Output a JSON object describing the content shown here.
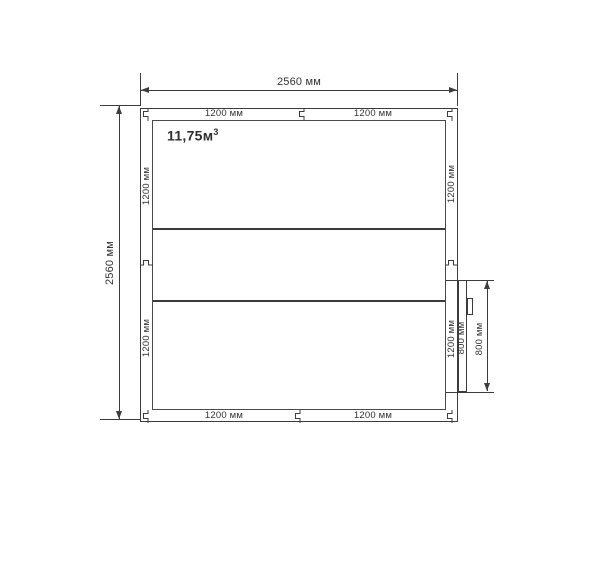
{
  "drawing": {
    "volume": {
      "value": "11,75м",
      "sup": "3"
    },
    "dims": {
      "top": "2560 мм",
      "left": "2560 мм",
      "door": "800 мм"
    },
    "wall_labels": {
      "top_left": "1200 мм",
      "top_right": "1200 мм",
      "bottom_left": "1200 мм",
      "bottom_right": "1200 мм",
      "left_top": "1200 мм",
      "left_bottom": "1200 мм",
      "right_top": "1200 мм",
      "right_bottom": "1200 мм",
      "door_panel": "800 мм"
    },
    "colors": {
      "ink": "#3c3c3c",
      "text": "#333333",
      "background": "#ffffff"
    }
  }
}
